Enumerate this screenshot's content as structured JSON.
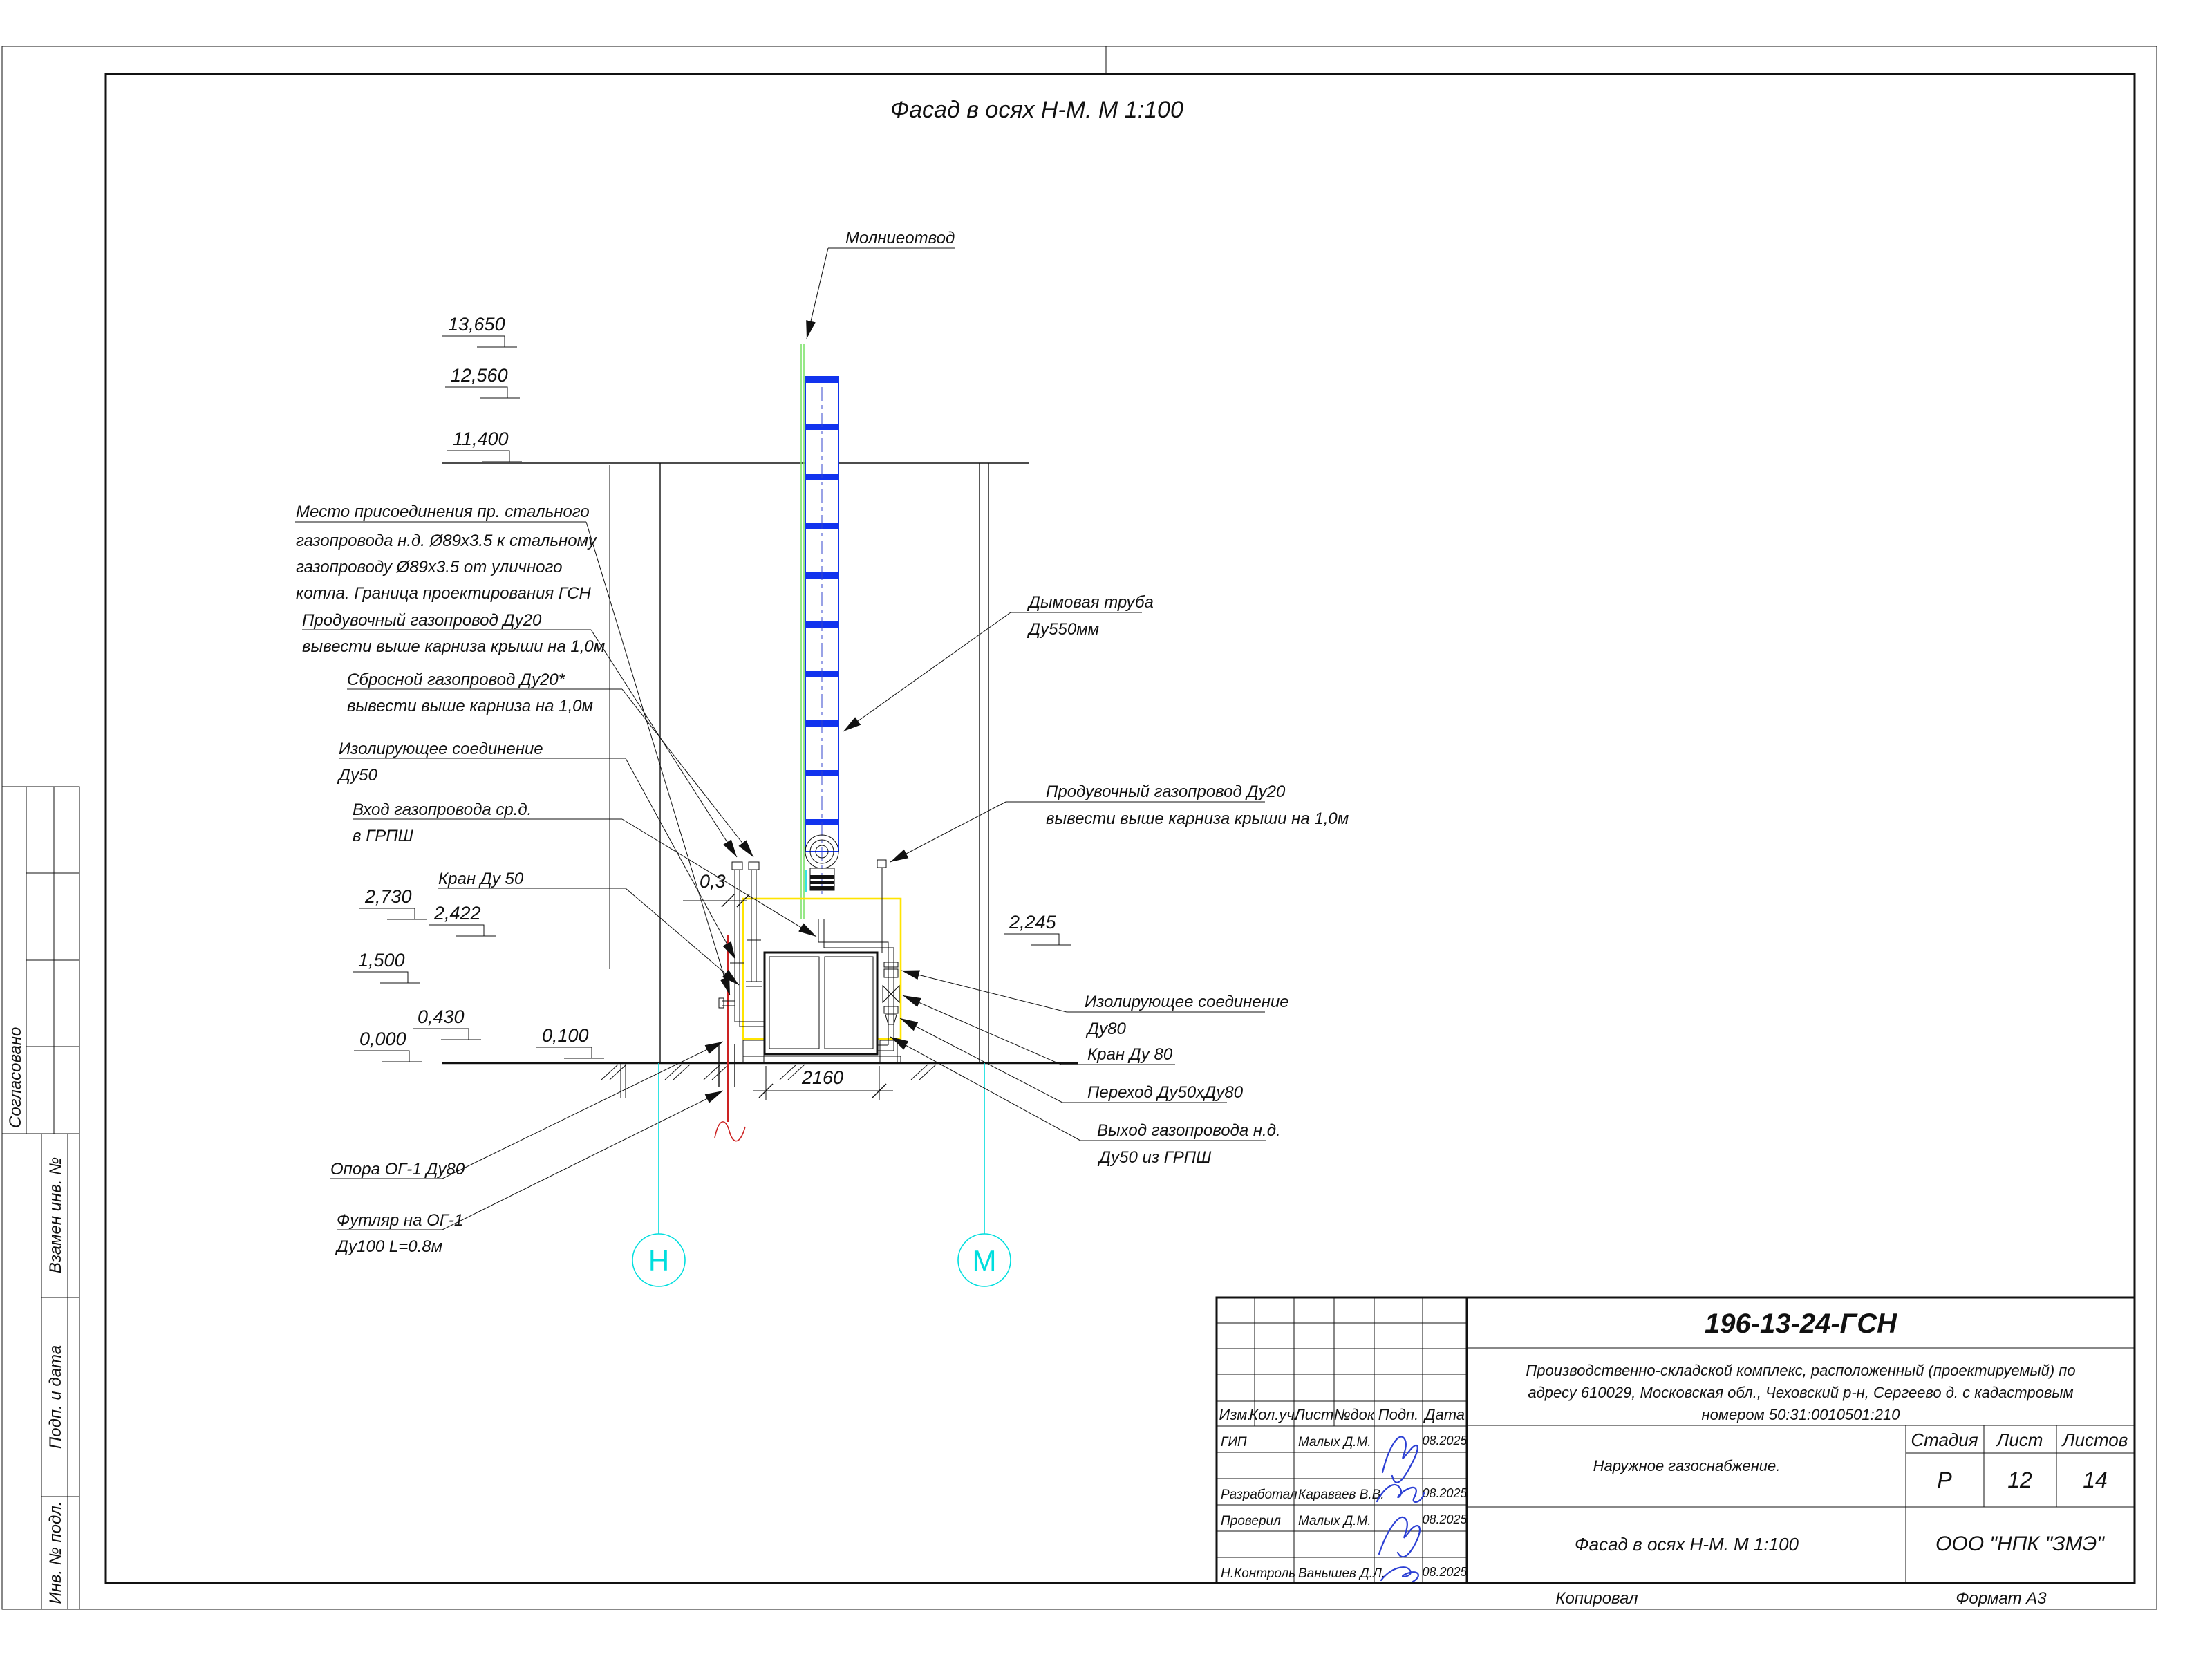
{
  "drawing_title": "Фасад в осях Н-М. М 1:100",
  "colors": {
    "chimney_blue": "#1133ee",
    "lightning_green": "#7de36b",
    "axis_cyan": "#00dede",
    "gas_red": "#cc2222",
    "zone_yellow": "#ffe400",
    "signature_blue": "#2b3fd4"
  },
  "annotations_left": {
    "connection": {
      "l1": "Место присоединения пр. стального",
      "l2": "газопровода н.д. Ø89х3.5 к стальному",
      "l3": "газопроводу Ø89х3.5 от уличного",
      "l4": "котла. Граница проектирования ГСН"
    },
    "purge": {
      "l1": "Продувочный газопровод Ду20",
      "l2": "вывести выше карниза крыши на 1,0м"
    },
    "relief": {
      "l1": "Сбросной газопровод Ду20*",
      "l2": "вывести выше карниза на 1,0м"
    },
    "insulating50": {
      "l1": "Изолирующее соединение",
      "l2": "Ду50"
    },
    "inlet": {
      "l1": "Вход газопровода ср.д.",
      "l2": "в ГРПШ"
    },
    "valve50": "Кран Ду 50",
    "support": "Опора ОГ-1 Ду80",
    "casing": {
      "l1": "Футляр на ОГ-1",
      "l2": "Ду100 L=0.8м"
    }
  },
  "annotations_right": {
    "lightning": "Молниеотвод",
    "chimney": {
      "l1": "Дымовая труба",
      "l2": "Ду550мм"
    },
    "purge2": {
      "l1": "Продувочный газопровод Ду20",
      "l2": "вывести выше карниза крыши на 1,0м"
    },
    "insulating80": {
      "l1": "Изолирующее соединение",
      "l2": "Ду80"
    },
    "valve80": "Кран Ду 80",
    "reducer": "Переход Ду50хДу80",
    "outlet": {
      "l1": "Выход газопровода н.д.",
      "l2": "Ду50 из ГРПШ"
    }
  },
  "elevations": {
    "e13650": "13,650",
    "e12560": "12,560",
    "e11400": "11,400",
    "e2730": "2,730",
    "e2422": "2,422",
    "e1500": "1,500",
    "e0430": "0,430",
    "e0000": "0,000",
    "e0100": "0,100",
    "e2245": "2,245"
  },
  "dimensions": {
    "cabinet_width": "2160",
    "offset": "0,3"
  },
  "axes": {
    "left": "Н",
    "right": "М"
  },
  "side_strip": {
    "agreed": "Согласовано",
    "replace_inv": "Взамен инв. №",
    "sign_date": "Подп. и дата",
    "inv_orig": "Инв. № подл."
  },
  "footer": {
    "copied": "Копировал",
    "format": "Формат А3"
  },
  "title_block": {
    "doc_number": "196-13-24-ГСН",
    "project": {
      "l1": "Производственно-складской комплекс, расположенный (проектируемый) по",
      "l2": "адресу 610029, Московская обл., Чеховский р-н, Сергеево д. с кадастровым",
      "l3": "номером 50:31:0010501:210"
    },
    "section": "Наружное газоснабжение.",
    "sheet_title": "Фасад в осях Н-М. М 1:100",
    "company": "ООО \"НПК \"ЗМЭ\"",
    "header": {
      "izm": "Изм.",
      "kol": "Кол.уч.",
      "list": "Лист",
      "ndok": "№док",
      "podp": "Подп.",
      "data": "Дата"
    },
    "stage_h": "Стадия",
    "sheet_h": "Лист",
    "sheets_h": "Листов",
    "stage": "Р",
    "sheet_no": "12",
    "sheets_total": "14",
    "rows": {
      "gip": {
        "role": "ГИП",
        "name": "Малых Д.М.",
        "date": "08.2025"
      },
      "dev": {
        "role": "Разработал",
        "name": "Караваев В.В.",
        "date": "08.2025"
      },
      "check": {
        "role": "Проверил",
        "name": "Малых Д.М.",
        "date": "08.2025"
      },
      "ncontrol": {
        "role": "Н.Контроль",
        "name": "Ванышев Д.Л.",
        "date": "08.2025"
      }
    }
  }
}
